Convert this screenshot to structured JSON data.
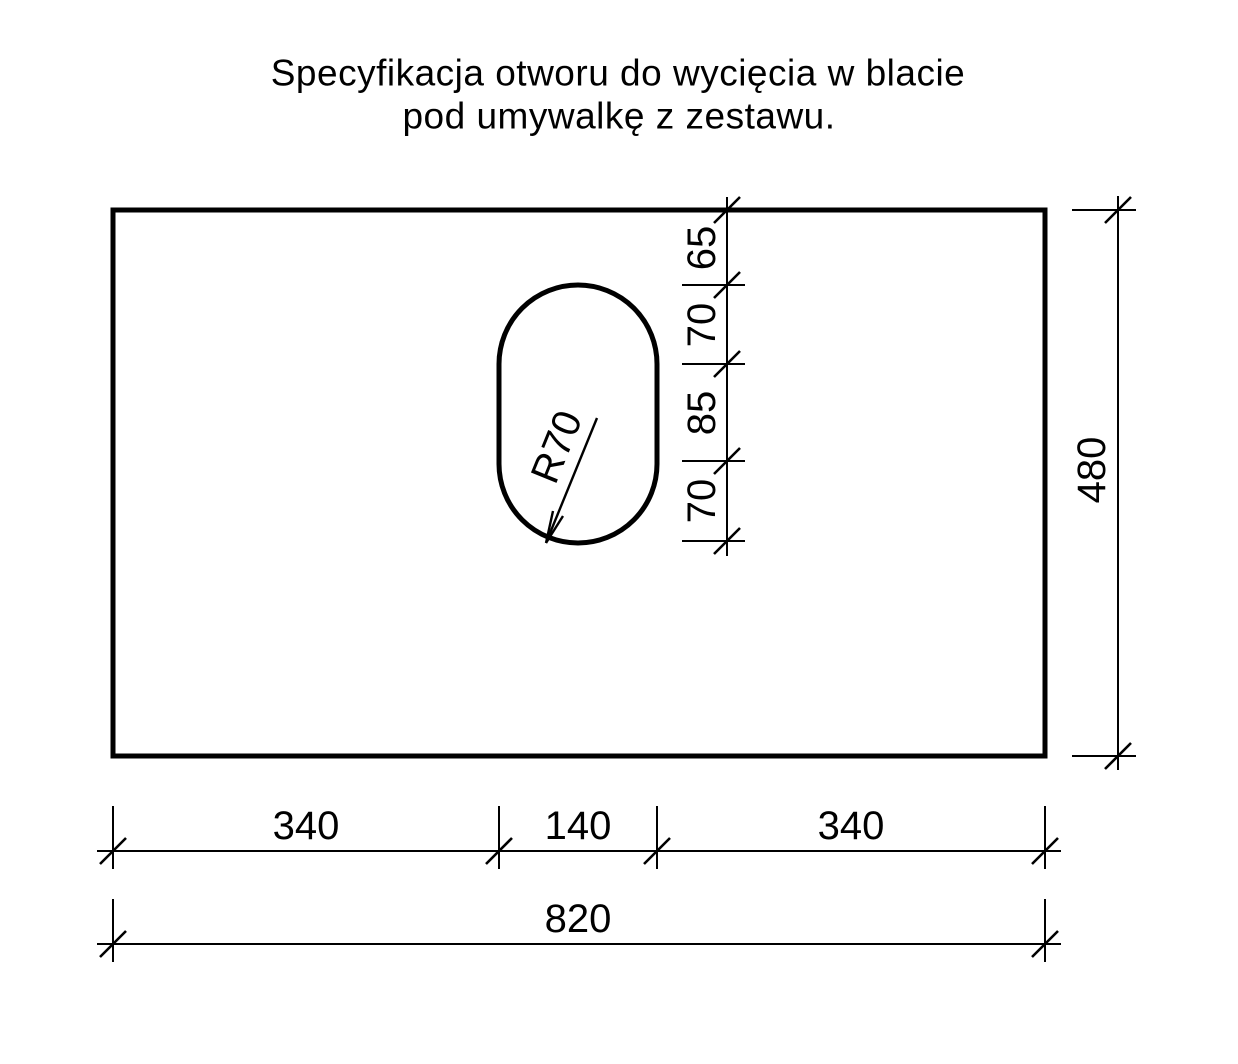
{
  "title": {
    "line1": "Specyfikacja otworu do wycięcia w blacie",
    "line2": "pod umywalkę z zestawu."
  },
  "hole": {
    "radius_label": "R70"
  },
  "dims": {
    "vertical_chain": [
      "65",
      "70",
      "85",
      "70"
    ],
    "height_total": "480",
    "bottom_chain": [
      "340",
      "140",
      "340"
    ],
    "width_total": "820"
  },
  "colors": {
    "line": "#000000",
    "background": "#ffffff"
  }
}
